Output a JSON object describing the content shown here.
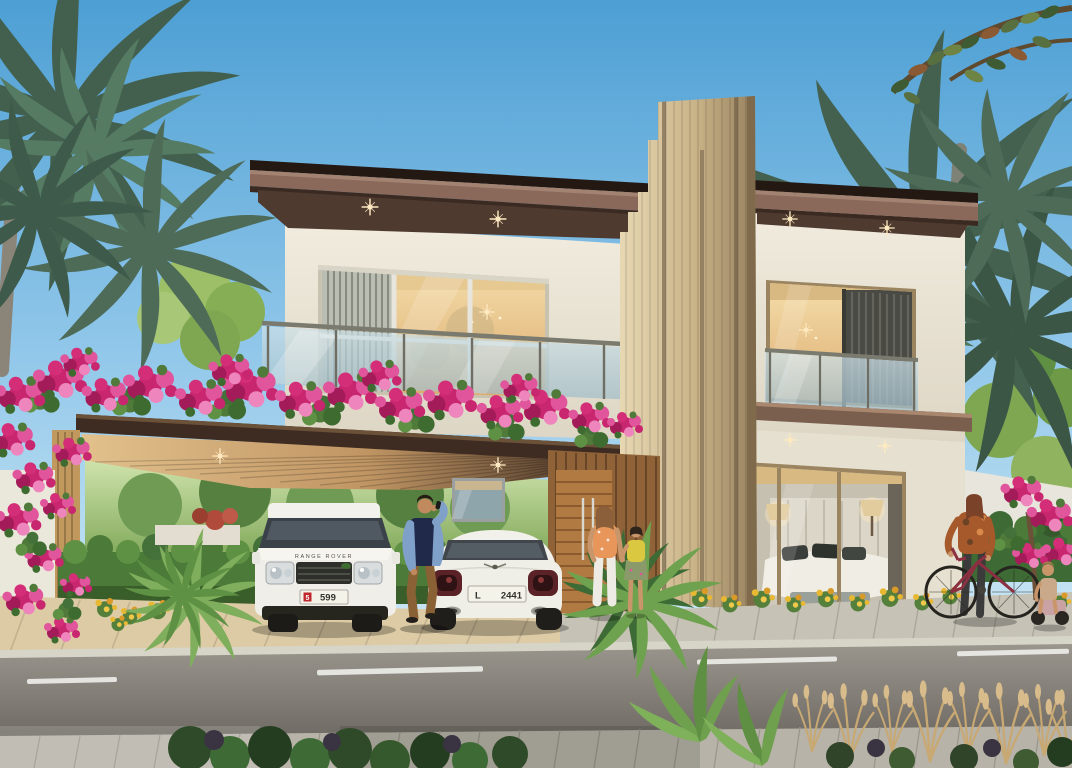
{
  "scene": {
    "description": "Daytime 3D architectural rendering of a modern two-storey villa with a bougainvillea-covered carport, two parked white cars, residents walking, palm trees and a street in the foreground"
  },
  "vehicles": {
    "suv": {
      "model_text": "RANGE ROVER",
      "plate_badge": "5",
      "plate_number": "599"
    },
    "coupe": {
      "plate_prefix": "L",
      "plate_number": "2441"
    }
  },
  "palette": {
    "sky_top": "#4D9FD4",
    "sky_horizon": "#C9E6F5",
    "roof_fascia_dark": "#241812",
    "roof_fascia_accent": "#8A685A",
    "wall_cream": "#EDE7D8",
    "feature_wood": "#C9B287",
    "carport_wood": "#D9B887",
    "door_wood": "#A9743E",
    "glass_blue": "#BFD8E2",
    "interior_glow": "#F2D8A2",
    "bougainvillea_pink": "#D42E78",
    "foliage_green": "#5F8C4A",
    "palm_green": "#4E6B58",
    "road_gray": "#8C8A85",
    "paver_tan": "#DCCBA4",
    "sidewalk_gray": "#B7B3A8",
    "lane_marking": "#EDEDE8"
  }
}
